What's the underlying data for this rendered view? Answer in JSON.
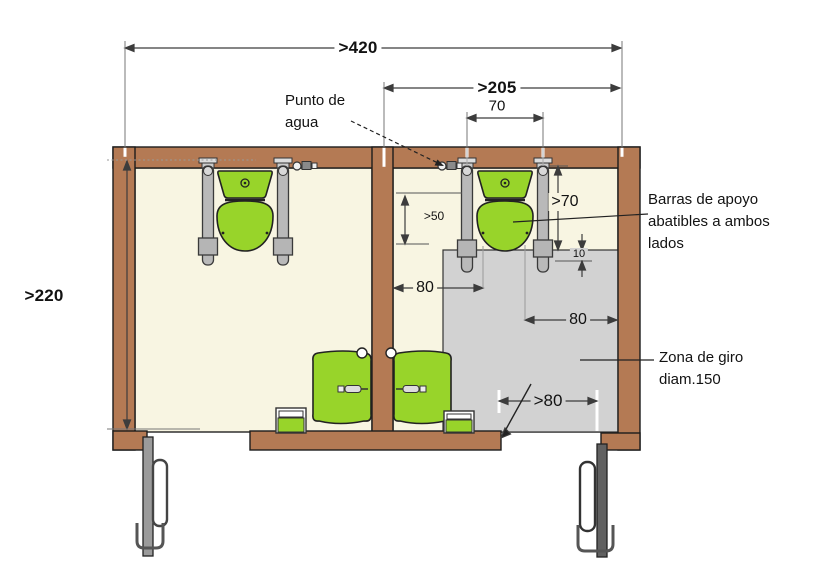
{
  "dims": {
    "w420": ">420",
    "w205": ">205",
    "w70": "70",
    "h220": ">220",
    "h50": ">50",
    "h70": ">70",
    "d10": "10",
    "d80_left": "80",
    "d80_right": "80",
    "d80_door": ">80"
  },
  "labels": {
    "water_point": "Punto de agua",
    "grab_bars": "Barras de apoyo abatibles a ambos lados",
    "turning_zone": "Zona de giro diam.150"
  },
  "colors": {
    "wall": "#b47a54",
    "floor": "#f8f5e2",
    "turning_zone": "#d2d2d2",
    "fixture_green": "#98d42a"
  }
}
